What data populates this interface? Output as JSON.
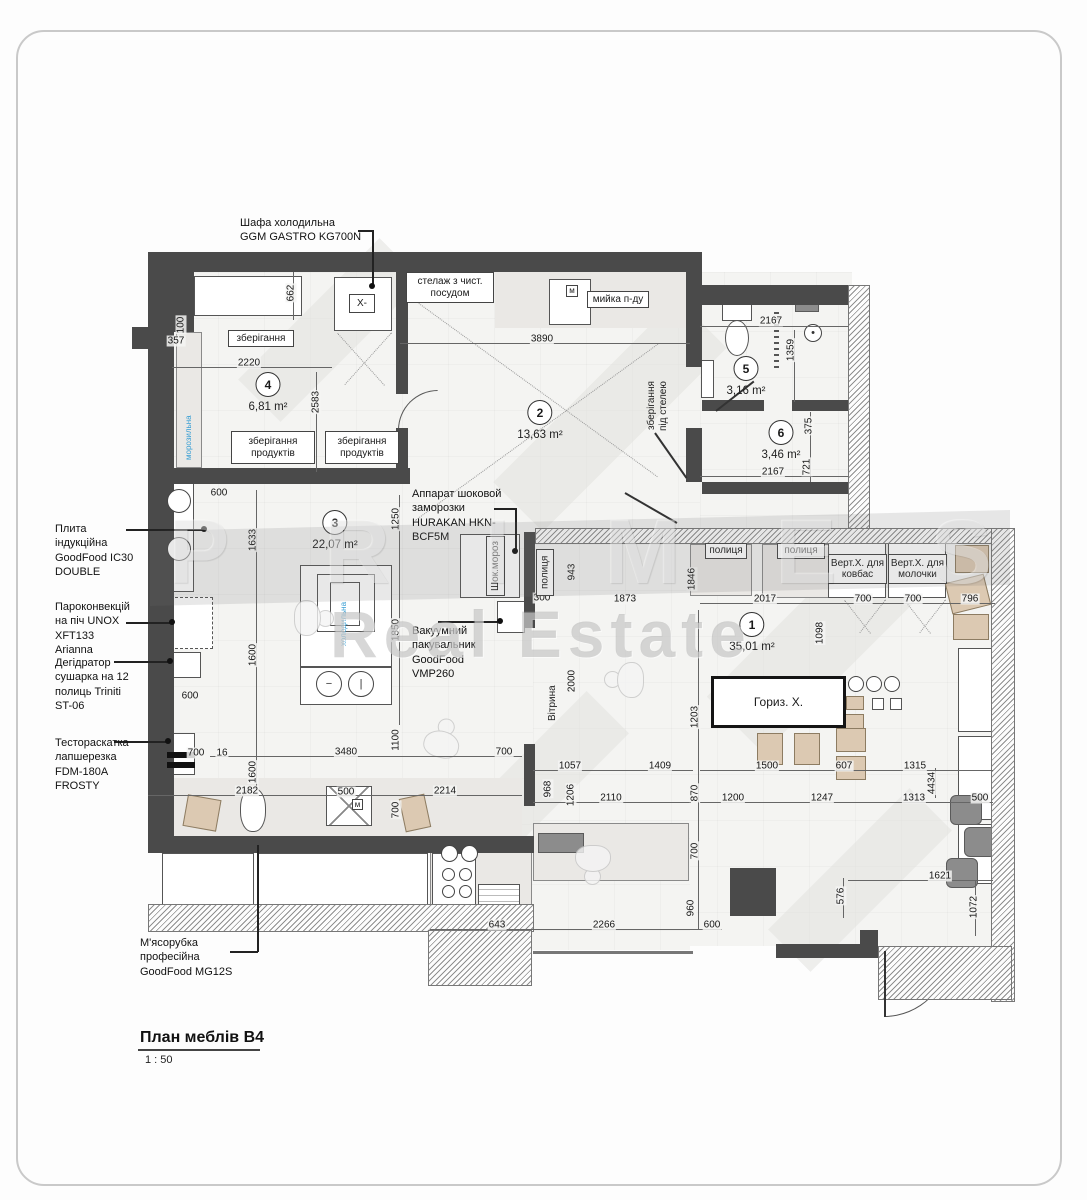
{
  "watermark": {
    "line1": "PRIMES",
    "line2": "Real Estate"
  },
  "title_block": {
    "title": "План меблів В4",
    "scale": "1 : 50"
  },
  "callouts": {
    "refrigerator_cabinet": "Шафа холодильна\nGGM GASTRO KG700N",
    "induction_stove": "Плита\nіндукційна\nGoodFood IC30\nDOUBLE",
    "convection_oven": "Пароконвекцій\nна піч UNOX\nXFT133\nArianna",
    "dehydrator": "Дегідратор\nсушарка на 12\nполиць Triniti\nST-06",
    "dough_sheeter": "Тестораскатка\nлапшерезка\nFDM-180A\nFROSTY",
    "meat_grinder": "М'ясорубка\nпрофесійна\nGoodFood MG12S",
    "shock_freezer": "Аппарат шоковой\nзаморозки\nHURAKAN HKN-\nBCF5M",
    "vacuum_sealer": "Вакуумний\nпакувальник\nGoodFood\nVMP260"
  },
  "rooms": [
    {
      "num": "1",
      "area": "35,01 m²",
      "x": 752,
      "y": 612
    },
    {
      "num": "2",
      "area": "13,63 m²",
      "x": 540,
      "y": 400
    },
    {
      "num": "3",
      "area": "22,07 m²",
      "x": 335,
      "y": 510
    },
    {
      "num": "4",
      "area": "6,81 m²",
      "x": 268,
      "y": 372
    },
    {
      "num": "5",
      "area": "3,16 m²",
      "x": 746,
      "y": 356
    },
    {
      "num": "6",
      "area": "3,46 m²",
      "x": 781,
      "y": 420
    }
  ],
  "plan_labels": [
    {
      "t": "зберігання",
      "x": 228,
      "y": 330,
      "w": 66,
      "h": 17,
      "cls": "lbox",
      "name": "label-storage"
    },
    {
      "t": "зберігання\nпродуктів",
      "x": 231,
      "y": 431,
      "w": 84,
      "h": 33,
      "cls": "lbox",
      "name": "label-food-storage-1"
    },
    {
      "t": "зберігання\nпродуктів",
      "x": 325,
      "y": 431,
      "w": 74,
      "h": 33,
      "cls": "lbox",
      "name": "label-food-storage-2"
    },
    {
      "t": "стелаж з чист.\nпосудом",
      "x": 406,
      "y": 272,
      "w": 88,
      "h": 31,
      "cls": "lbox",
      "name": "label-clean-dish-rack"
    },
    {
      "t": "мийка п-ду",
      "x": 587,
      "y": 291,
      "w": 62,
      "h": 17,
      "cls": "lbox",
      "name": "label-sink"
    },
    {
      "t": "X-",
      "x": 349,
      "y": 294,
      "w": 26,
      "h": 19,
      "cls": "lbox",
      "name": "label-fridge-x"
    },
    {
      "t": "зберігання\nпід стелею",
      "x": 646,
      "y": 358,
      "w": 32,
      "h": 96,
      "cls": "vplain",
      "name": "label-ceiling-storage"
    },
    {
      "t": "Шок.мороз",
      "x": 486,
      "y": 536,
      "w": 19,
      "h": 60,
      "cls": "vlbox",
      "name": "label-shock-freezer"
    },
    {
      "t": "полиця",
      "x": 536,
      "y": 549,
      "w": 18,
      "h": 47,
      "cls": "vlbox",
      "name": "label-shelf-v"
    },
    {
      "t": "Вітрина",
      "x": 547,
      "y": 684,
      "w": 16,
      "h": 38,
      "cls": "vplain",
      "name": "label-vitrine"
    },
    {
      "t": "полиця",
      "x": 705,
      "y": 543,
      "w": 42,
      "h": 16,
      "cls": "lbox",
      "name": "label-shelf-1"
    },
    {
      "t": "полиця",
      "x": 777,
      "y": 543,
      "w": 48,
      "h": 16,
      "cls": "lbox",
      "name": "label-shelf-2"
    },
    {
      "t": "Верт.Х. для\nковбас",
      "x": 828,
      "y": 554,
      "w": 59,
      "h": 30,
      "cls": "lbox",
      "name": "label-vert-fridge-sausage"
    },
    {
      "t": "Верт.Х. для\nмолочки",
      "x": 888,
      "y": 554,
      "w": 59,
      "h": 30,
      "cls": "lbox",
      "name": "label-vert-fridge-dairy"
    },
    {
      "t": "Гориз. Х.",
      "x": 711,
      "y": 676,
      "w": 135,
      "h": 52,
      "cls": "bigbox",
      "name": "label-horizontal-fridge"
    },
    {
      "t": "морозильна",
      "x": 184,
      "y": 386,
      "w": 15,
      "h": 74,
      "cls": "vblue",
      "name": "label-freezer-blue"
    },
    {
      "t": "холодильна",
      "x": 339,
      "y": 580,
      "w": 13,
      "h": 66,
      "cls": "vblue",
      "name": "label-fridge-blue"
    },
    {
      "t": "м",
      "x": 566,
      "y": 285,
      "w": 12,
      "h": 12,
      "cls": "lbox-s",
      "name": "label-m-marker-1"
    },
    {
      "t": "м",
      "x": 352,
      "y": 799,
      "w": 11,
      "h": 11,
      "cls": "lbox-s",
      "name": "label-m-marker-2"
    }
  ],
  "dims": [
    {
      "t": "357",
      "x": 176,
      "y": 341,
      "o": "h"
    },
    {
      "t": "100",
      "x": 181,
      "y": 325,
      "o": "v"
    },
    {
      "t": "662",
      "x": 291,
      "y": 293,
      "o": "v"
    },
    {
      "t": "2220",
      "x": 249,
      "y": 363,
      "o": "h"
    },
    {
      "t": "2583",
      "x": 316,
      "y": 402,
      "o": "v"
    },
    {
      "t": "3890",
      "x": 542,
      "y": 339,
      "o": "h"
    },
    {
      "t": "2167",
      "x": 771,
      "y": 321,
      "o": "h"
    },
    {
      "t": "1359",
      "x": 791,
      "y": 350,
      "o": "v"
    },
    {
      "t": "375",
      "x": 809,
      "y": 426,
      "o": "v"
    },
    {
      "t": "721",
      "x": 807,
      "y": 467,
      "o": "v"
    },
    {
      "t": "2167",
      "x": 773,
      "y": 472,
      "o": "h"
    },
    {
      "t": "600",
      "x": 219,
      "y": 493,
      "o": "h"
    },
    {
      "t": "1633",
      "x": 253,
      "y": 540,
      "o": "v"
    },
    {
      "t": "1250",
      "x": 396,
      "y": 519,
      "o": "v"
    },
    {
      "t": "1850",
      "x": 396,
      "y": 630,
      "o": "v"
    },
    {
      "t": "1600",
      "x": 253,
      "y": 655,
      "o": "v"
    },
    {
      "t": "600",
      "x": 190,
      "y": 696,
      "o": "h"
    },
    {
      "t": "1600",
      "x": 253,
      "y": 772,
      "o": "v"
    },
    {
      "t": "700",
      "x": 196,
      "y": 753,
      "o": "h"
    },
    {
      "t": "16",
      "x": 222,
      "y": 753,
      "o": "h"
    },
    {
      "t": "2182",
      "x": 247,
      "y": 791,
      "o": "h"
    },
    {
      "t": "3480",
      "x": 346,
      "y": 752,
      "o": "h"
    },
    {
      "t": "1100",
      "x": 396,
      "y": 740,
      "o": "v"
    },
    {
      "t": "500",
      "x": 346,
      "y": 792,
      "o": "h"
    },
    {
      "t": "2214",
      "x": 445,
      "y": 791,
      "o": "h"
    },
    {
      "t": "700",
      "x": 396,
      "y": 810,
      "o": "v"
    },
    {
      "t": "700",
      "x": 504,
      "y": 752,
      "o": "h"
    },
    {
      "t": "968",
      "x": 548,
      "y": 789,
      "o": "v"
    },
    {
      "t": "1206",
      "x": 571,
      "y": 795,
      "o": "v"
    },
    {
      "t": "1057",
      "x": 570,
      "y": 766,
      "o": "h"
    },
    {
      "t": "2110",
      "x": 611,
      "y": 798,
      "o": "h"
    },
    {
      "t": "1409",
      "x": 660,
      "y": 766,
      "o": "h"
    },
    {
      "t": "300",
      "x": 542,
      "y": 598,
      "o": "h"
    },
    {
      "t": "943",
      "x": 572,
      "y": 572,
      "o": "v"
    },
    {
      "t": "1873",
      "x": 625,
      "y": 599,
      "o": "h"
    },
    {
      "t": "1846",
      "x": 692,
      "y": 579,
      "o": "v"
    },
    {
      "t": "2000",
      "x": 572,
      "y": 681,
      "o": "v"
    },
    {
      "t": "2017",
      "x": 765,
      "y": 599,
      "o": "h"
    },
    {
      "t": "700",
      "x": 863,
      "y": 599,
      "o": "h"
    },
    {
      "t": "700",
      "x": 913,
      "y": 599,
      "o": "h"
    },
    {
      "t": "796",
      "x": 970,
      "y": 599,
      "o": "h"
    },
    {
      "t": "1098",
      "x": 820,
      "y": 633,
      "o": "v"
    },
    {
      "t": "1203",
      "x": 695,
      "y": 717,
      "o": "v"
    },
    {
      "t": "870",
      "x": 695,
      "y": 793,
      "o": "v"
    },
    {
      "t": "700",
      "x": 695,
      "y": 851,
      "o": "v"
    },
    {
      "t": "960",
      "x": 691,
      "y": 908,
      "o": "v"
    },
    {
      "t": "600",
      "x": 712,
      "y": 925,
      "o": "h"
    },
    {
      "t": "2266",
      "x": 604,
      "y": 925,
      "o": "h"
    },
    {
      "t": "643",
      "x": 497,
      "y": 925,
      "o": "h"
    },
    {
      "t": "1500",
      "x": 767,
      "y": 766,
      "o": "h"
    },
    {
      "t": "607",
      "x": 844,
      "y": 766,
      "o": "h"
    },
    {
      "t": "1315",
      "x": 915,
      "y": 766,
      "o": "h"
    },
    {
      "t": "1200",
      "x": 733,
      "y": 798,
      "o": "h"
    },
    {
      "t": "1247",
      "x": 822,
      "y": 798,
      "o": "h"
    },
    {
      "t": "1313",
      "x": 914,
      "y": 798,
      "o": "h"
    },
    {
      "t": "4434",
      "x": 932,
      "y": 783,
      "o": "v"
    },
    {
      "t": "500",
      "x": 980,
      "y": 798,
      "o": "h"
    },
    {
      "t": "1621",
      "x": 940,
      "y": 876,
      "o": "h"
    },
    {
      "t": "576",
      "x": 841,
      "y": 896,
      "o": "v"
    },
    {
      "t": "1072",
      "x": 974,
      "y": 907,
      "o": "v"
    }
  ]
}
